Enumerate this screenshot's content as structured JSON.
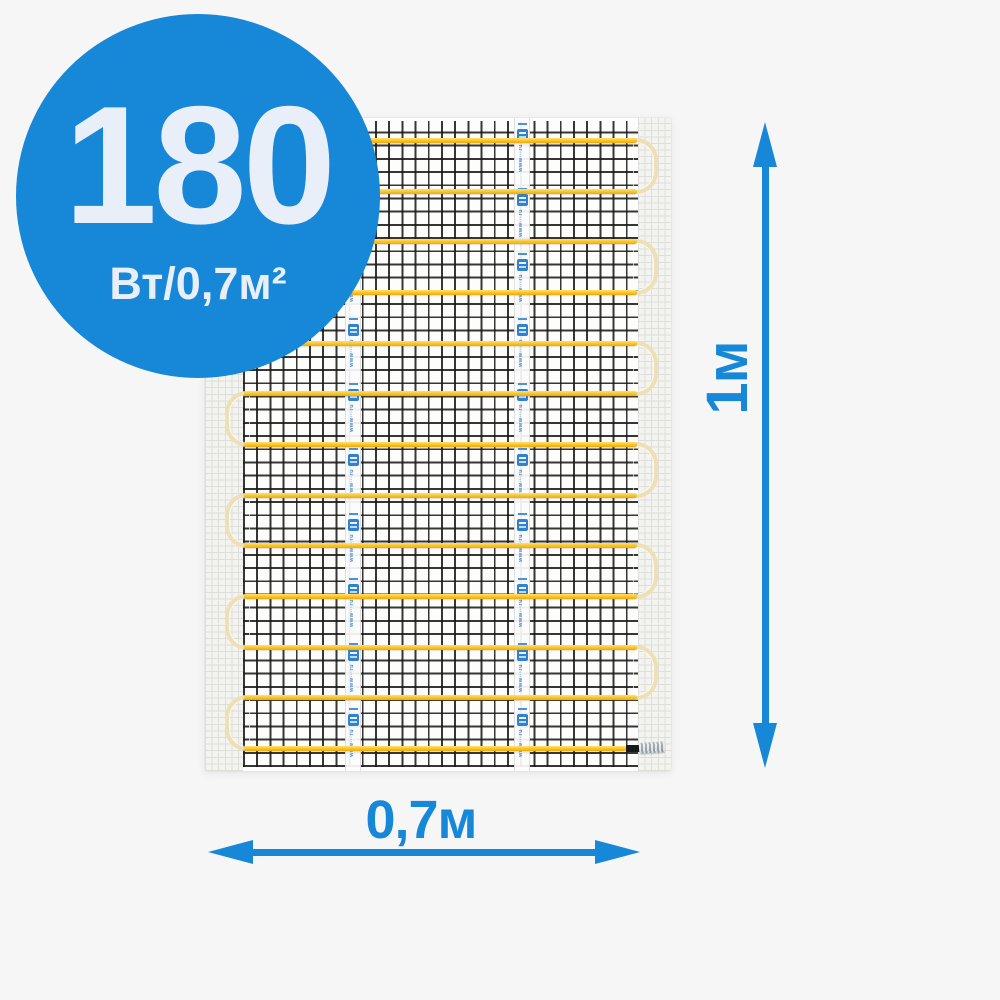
{
  "badge": {
    "power_value": "180",
    "power_unit": "Вт/0,7м²",
    "bg_color": "#1787D8",
    "text_color": "#E9EFF9"
  },
  "dimensions": {
    "height_label": "1м",
    "width_label": "0,7м",
    "arrow_color": "#1787D8"
  },
  "mat": {
    "tape_watermark": "www···ru",
    "cable_color": "#FBC830",
    "loop_color": "#EEDFB4",
    "mesh_color": "#181818",
    "tape_logo_color": "#2E82CF",
    "cable_rows_y": [
      140,
      191,
      241,
      292,
      343,
      393,
      444,
      495,
      545,
      596,
      647,
      697,
      748
    ],
    "cable_x_start": 244,
    "cable_x_end": 637,
    "last_row_x_end": 627,
    "right_loop_top_rows": [
      0,
      2,
      4,
      6,
      8,
      10
    ],
    "left_loop_top_rows": [
      1,
      3,
      5,
      7,
      9,
      11
    ],
    "tapes_x": [
      345,
      514
    ],
    "tape_units_per_strip": 10
  }
}
